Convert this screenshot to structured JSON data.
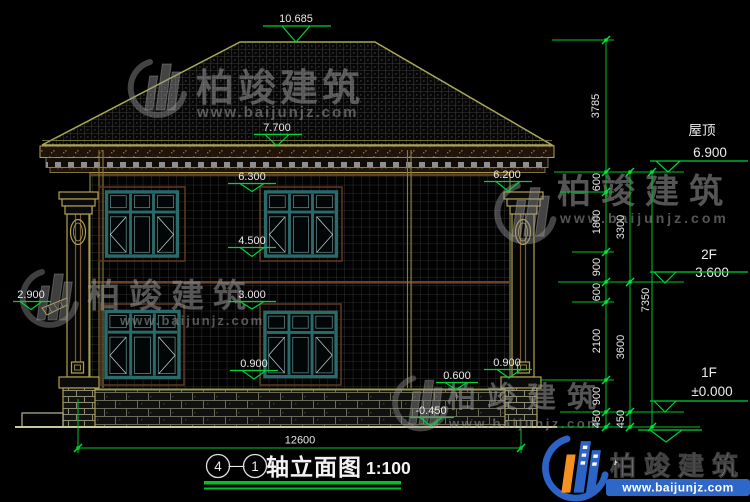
{
  "page": {
    "background": "#000000",
    "accent_green": "#00c22e"
  },
  "title_block": {
    "axis_start": "4",
    "axis_separator": "—",
    "axis_end": "1",
    "name": "轴立面图",
    "scale": "1:100"
  },
  "dims": {
    "total_width": "12600",
    "height_above_eave": "3785",
    "chain_inner": [
      "600",
      "1800",
      "900",
      "600",
      "2100",
      "900",
      "450"
    ],
    "chain_mid": [
      "3300",
      "3600",
      "450"
    ],
    "total_height": "7350"
  },
  "levels": {
    "ridge": "10.685",
    "eave": "7.700",
    "win2_top": "6.300",
    "pilaster_top": "6.200",
    "win2_sill": "4.500",
    "win1_top": "3.000",
    "side_ledge": "2.900",
    "win1_sill_left": "0.900",
    "win1_sill_right": "0.900",
    "base_top": "0.600",
    "ground": "-0.450"
  },
  "floors": {
    "roof_label": "屋顶",
    "roof_elev": "6.900",
    "f2_label": "2F",
    "f2_elev": "3.600",
    "f1_label": "1F",
    "f1_elev": "±0.000"
  },
  "watermark": {
    "brand": "柏竣建筑",
    "site": "www.baijunjz.com"
  }
}
